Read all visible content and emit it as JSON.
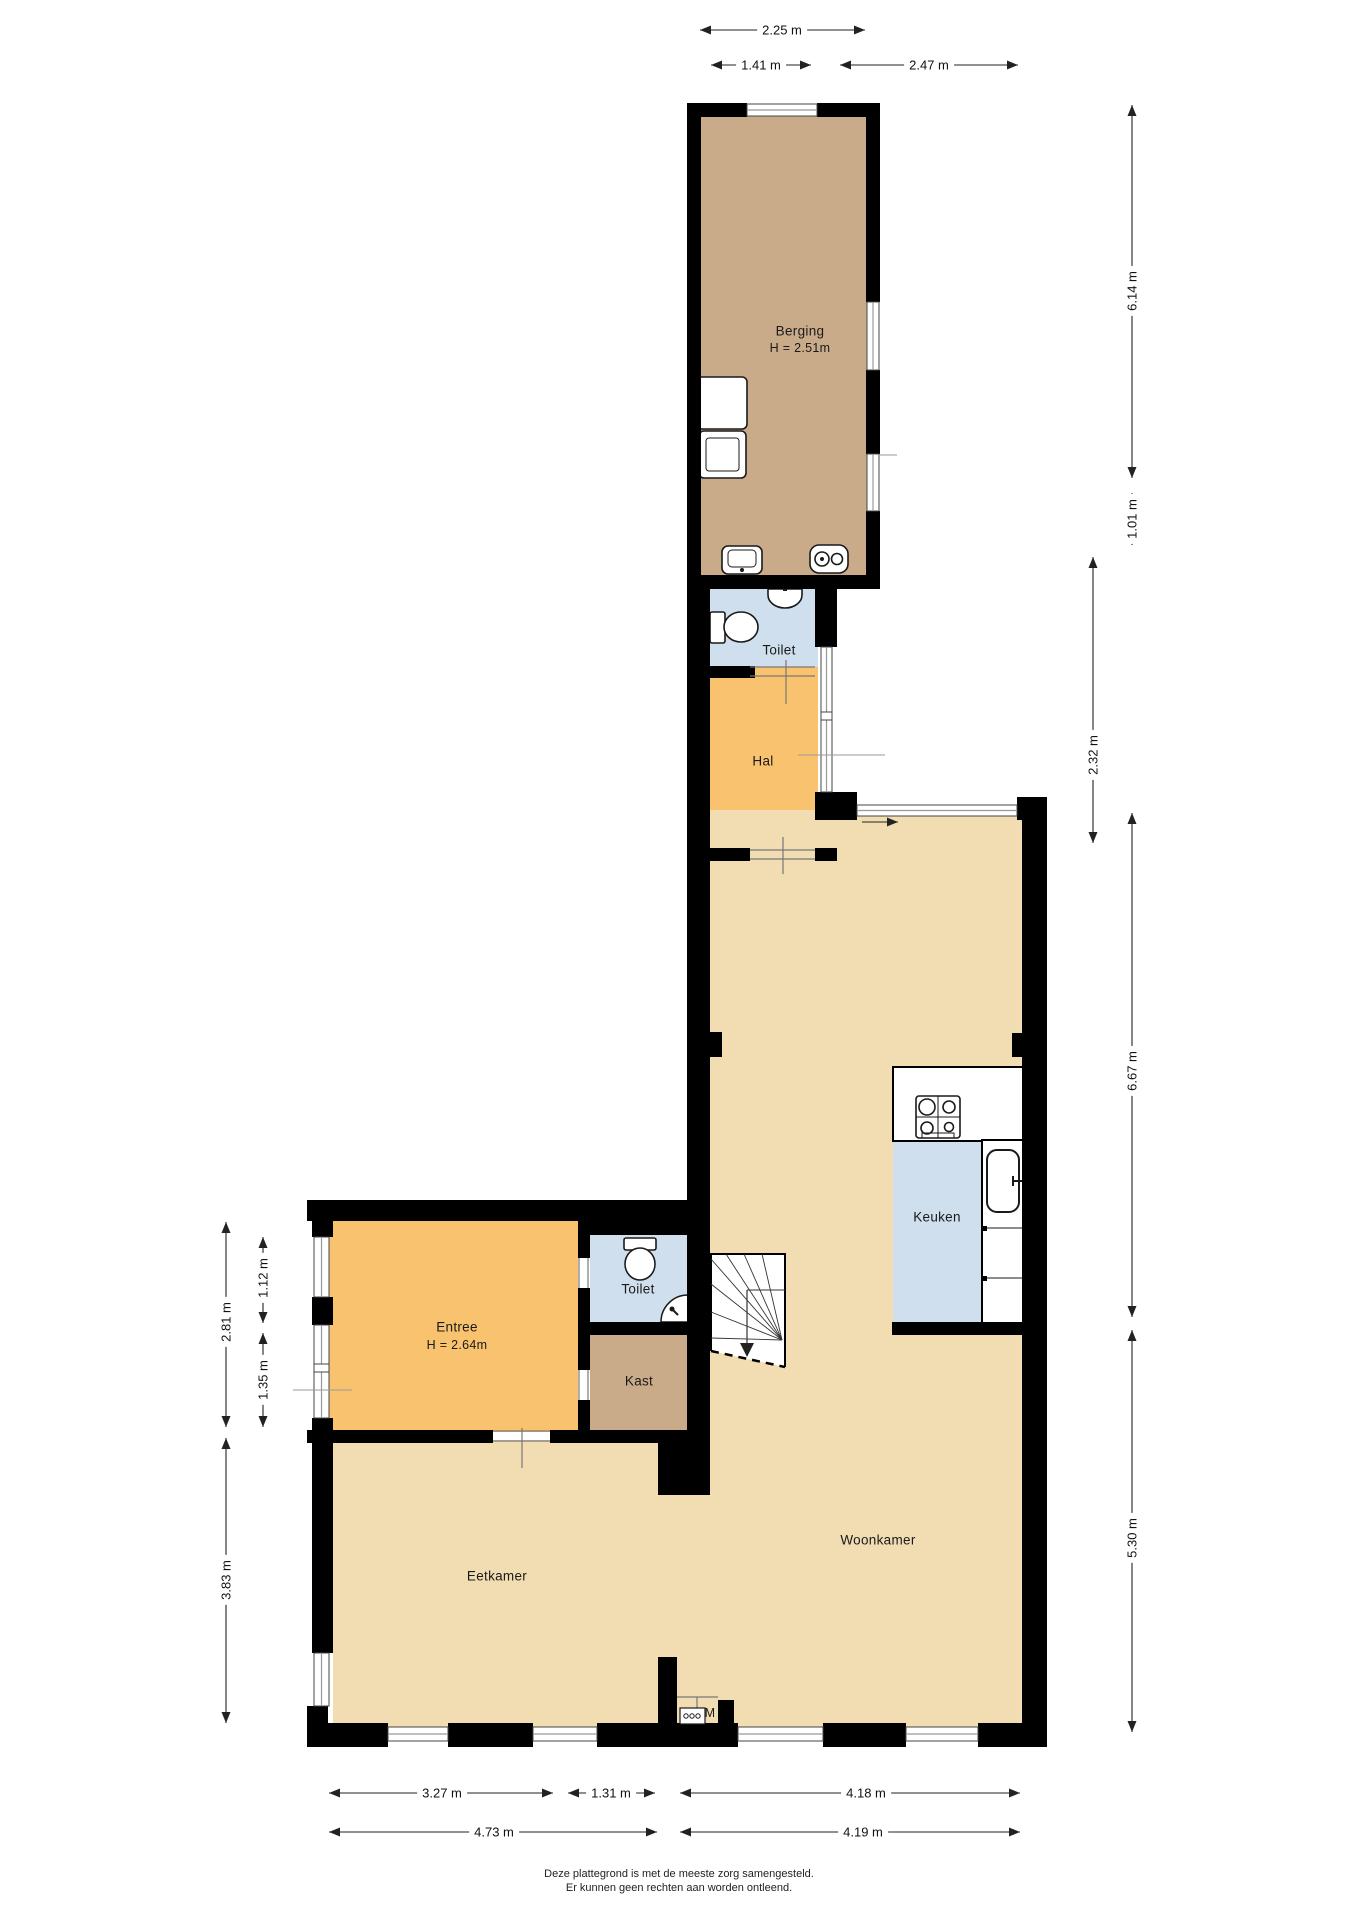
{
  "plan_title": "Begane grond plattegrond",
  "rooms": {
    "berging": {
      "label": "Berging",
      "height_note": "H = 2.51m"
    },
    "toilet_top": {
      "label": "Toilet"
    },
    "hal": {
      "label": "Hal"
    },
    "keuken": {
      "label": "Keuken"
    },
    "entree": {
      "label": "Entree",
      "height_note": "H = 2.64m"
    },
    "toilet_bottom": {
      "label": "Toilet"
    },
    "kast": {
      "label": "Kast"
    },
    "eetkamer": {
      "label": "Eetkamer"
    },
    "woonkamer": {
      "label": "Woonkamer"
    },
    "meterkast": {
      "label": "M"
    }
  },
  "dimensions": {
    "top": [
      "2.25 m",
      "1.41 m",
      "2.47 m"
    ],
    "right": [
      "6.14 m",
      "1.01 m",
      "2.32 m",
      "6.67 m",
      "5.30 m"
    ],
    "left": [
      "2.81 m",
      "1.12 m",
      "1.35 m",
      "3.83 m"
    ],
    "bottom_row1": [
      "3.27 m",
      "1.31 m",
      "4.18 m"
    ],
    "bottom_row2": [
      "4.73 m",
      "4.19 m"
    ]
  },
  "footer": {
    "line1": "Deze plattegrond is met de meeste zorg samengesteld.",
    "line2": "Er kunnen geen rechten aan worden ontleend."
  },
  "colors": {
    "wall": "#000000",
    "floor_tan": "#f2ddb3",
    "floor_brown": "#c9ab89",
    "floor_orange": "#f9c26e",
    "floor_blue": "#cfdfee"
  },
  "icons": [
    "washer-icon",
    "dryer-icon",
    "sink-icon",
    "boiler-icon",
    "toilet-icon",
    "stairs-icon",
    "hob-icon",
    "kitchen-sink-icon",
    "door-swing-icon",
    "meter-box-icon"
  ]
}
